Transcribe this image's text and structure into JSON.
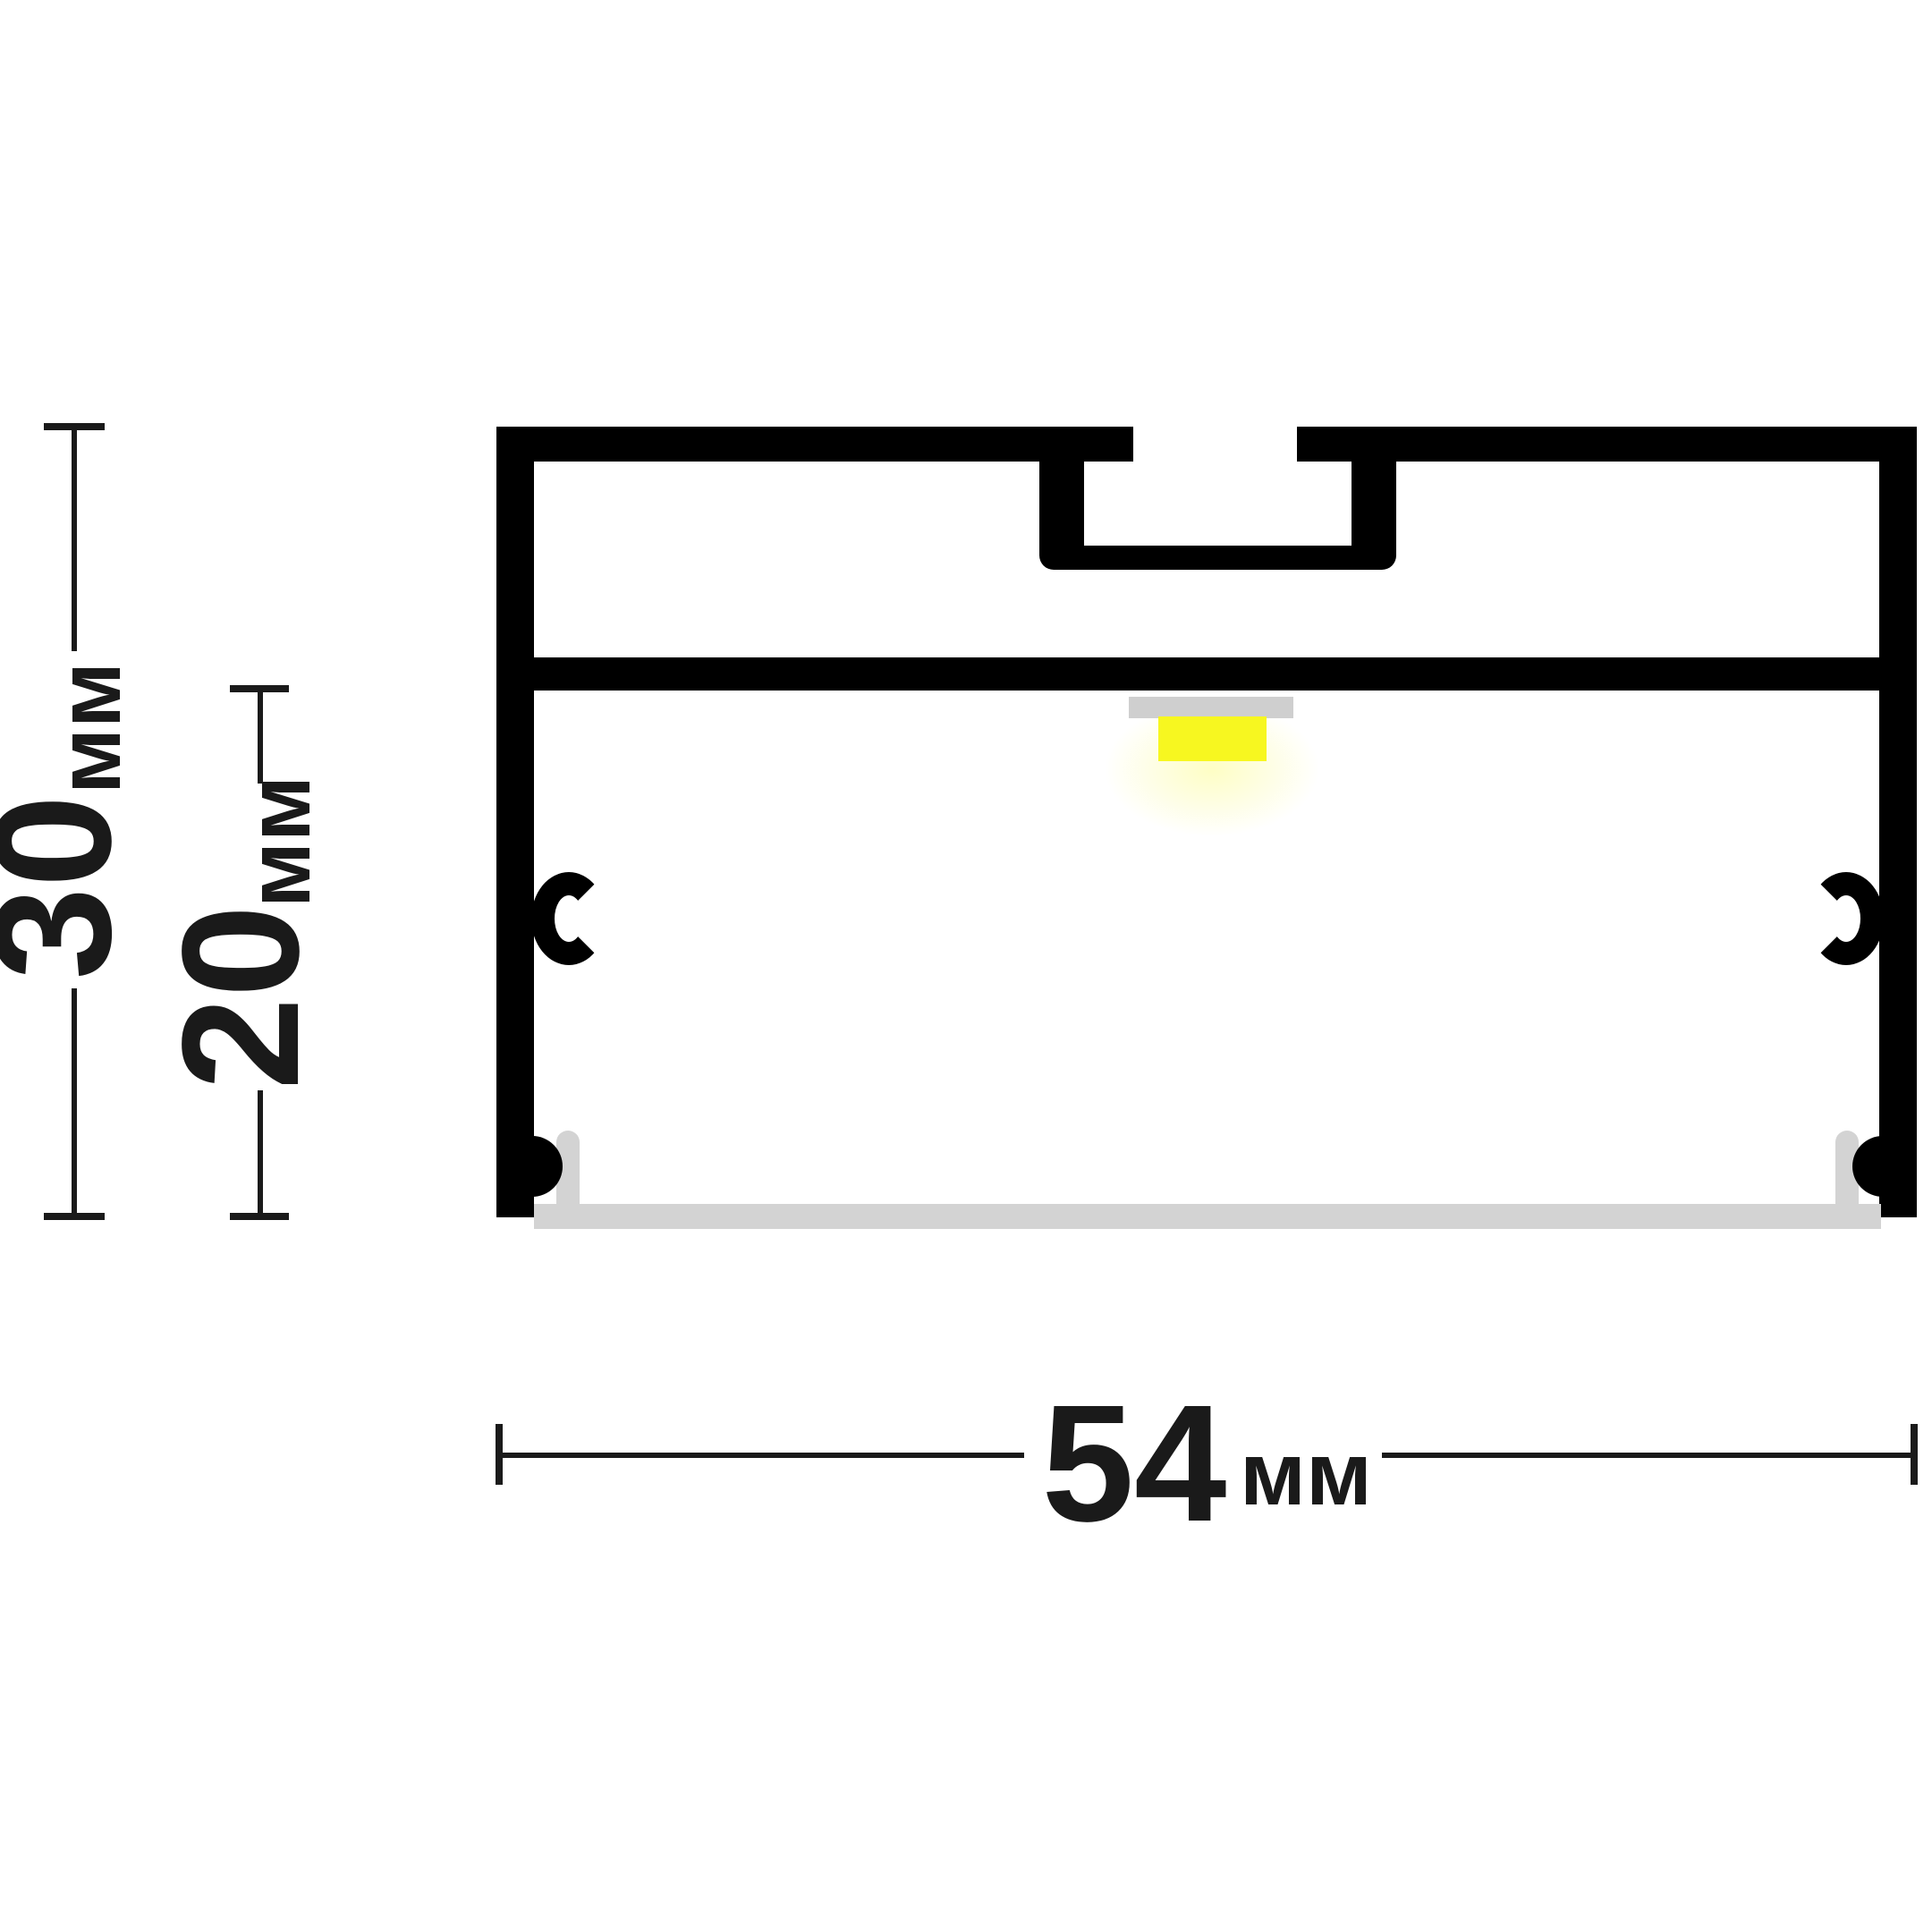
{
  "diagram": {
    "type": "technical-drawing",
    "subject": "led-profile-cross-section",
    "background": "#ffffff",
    "colors": {
      "outline": "#000000",
      "dimension": "#1a1a1a",
      "led_strip": "#f7f720",
      "led_glow": "rgba(250,250,60,0.30)",
      "led_pcb": "#cfcfcf",
      "diffuser": "#d3d3d3"
    },
    "dimensions": {
      "height_total": {
        "value": "30",
        "unit": "мм",
        "orientation": "vertical"
      },
      "height_inner": {
        "value": "20",
        "unit": "мм",
        "orientation": "vertical"
      },
      "width_total": {
        "value": "54",
        "unit": "мм",
        "orientation": "horizontal"
      }
    }
  }
}
